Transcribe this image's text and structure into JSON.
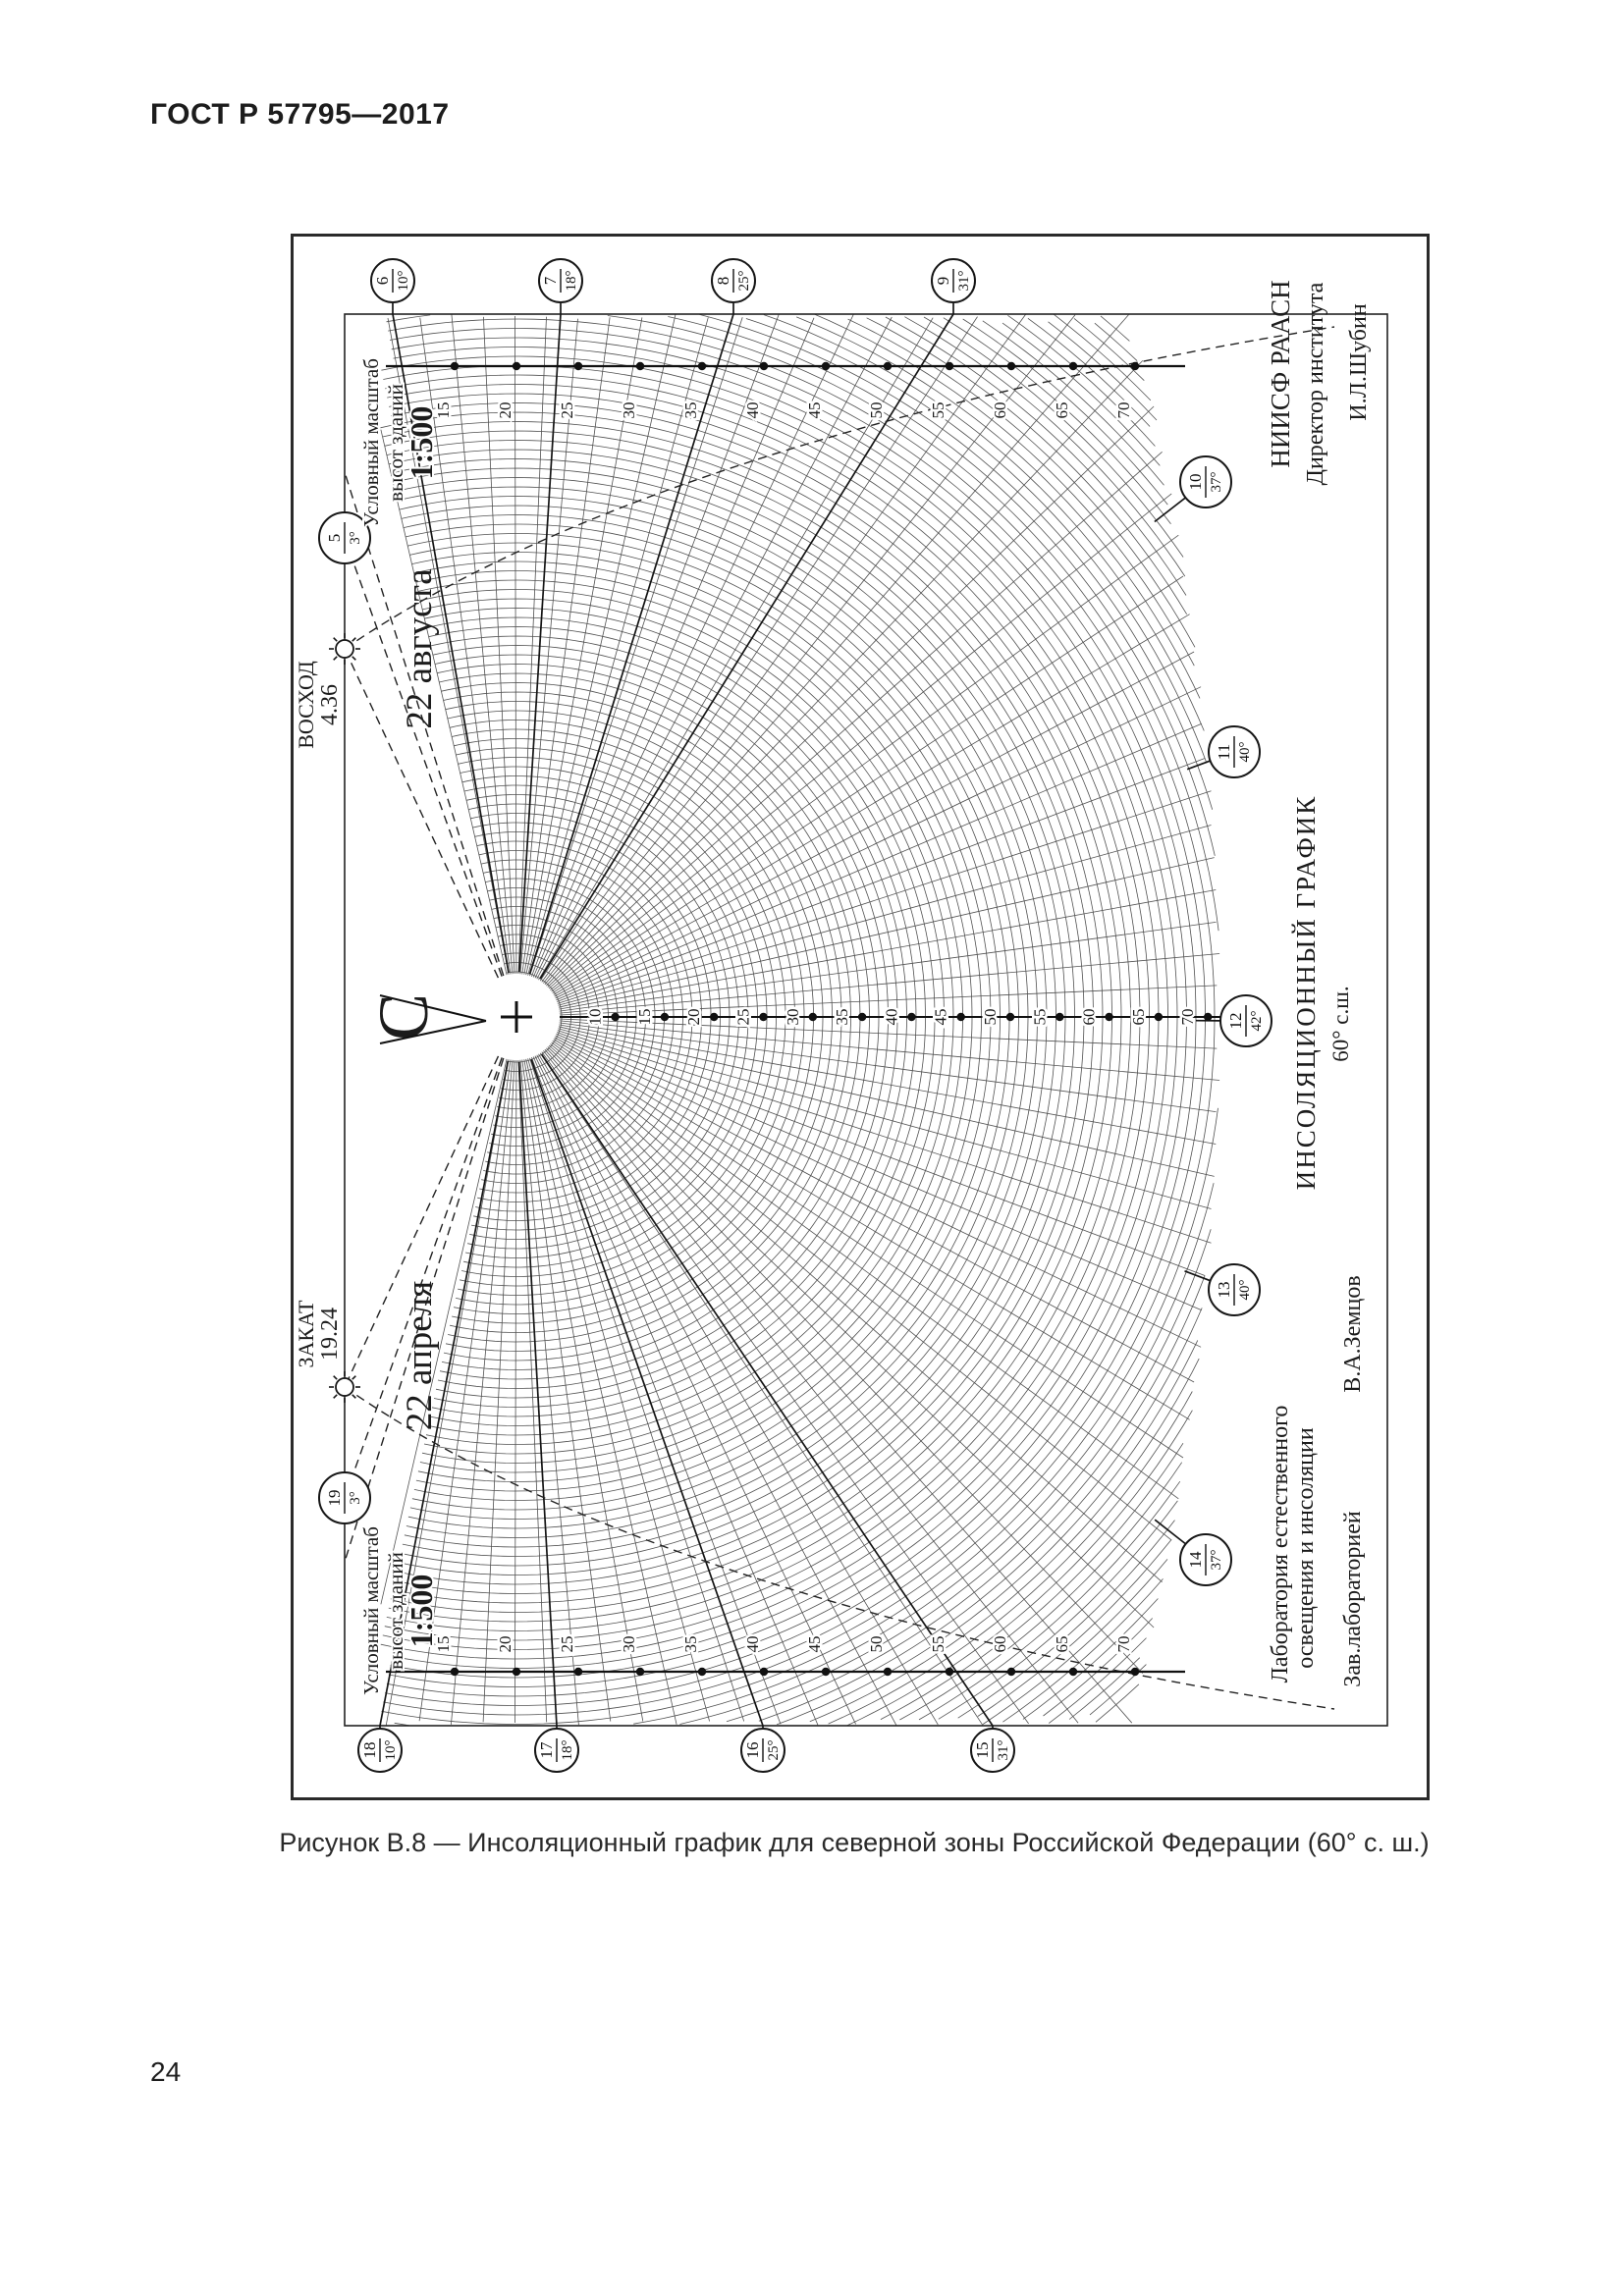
{
  "page": {
    "header": "ГОСТ Р 57795—2017",
    "page_number": "24",
    "figure_caption": "Рисунок В.8 — Инсоляционный график для северной зоны Российской Федерации (60° с. ш.)"
  },
  "chart": {
    "date_upper": "22  августа",
    "date_lower": "22  апреля",
    "sunrise": {
      "label": "ВОСХОД",
      "time": "4.36"
    },
    "sunset": {
      "label": "ЗАКАТ",
      "time": "19.24"
    },
    "scale_note": {
      "line1": "Условный масштаб",
      "line2": "высот зданий",
      "line3": "1:500"
    },
    "north_symbol": "С",
    "hour_markers": [
      {
        "hour": "5",
        "alt": "3°"
      },
      {
        "hour": "6",
        "alt": "10°"
      },
      {
        "hour": "7",
        "alt": "18°"
      },
      {
        "hour": "8",
        "alt": "25°"
      },
      {
        "hour": "9",
        "alt": "31°"
      },
      {
        "hour": "10",
        "alt": "37°"
      },
      {
        "hour": "11",
        "alt": "40°"
      },
      {
        "hour": "12",
        "alt": "42°"
      },
      {
        "hour": "13",
        "alt": "40°"
      },
      {
        "hour": "14",
        "alt": "37°"
      },
      {
        "hour": "15",
        "alt": "31°"
      },
      {
        "hour": "16",
        "alt": "25°"
      },
      {
        "hour": "17",
        "alt": "18°"
      },
      {
        "hour": "18",
        "alt": "10°"
      },
      {
        "hour": "19",
        "alt": "3°"
      }
    ],
    "ruler_values": [
      15,
      20,
      25,
      30,
      35,
      40,
      45,
      50,
      55,
      60,
      65,
      70
    ],
    "axis_values": [
      10,
      15,
      20,
      25,
      30,
      35,
      40,
      45,
      50,
      55,
      60,
      65,
      70
    ],
    "title_block": {
      "org_line1": "НИИСФ РААСН",
      "org_line2": "Директор института",
      "org_sign": "И.Л.Шубин",
      "chart_title": "ИНСОЛЯЦИОННЫЙ  ГРАФИК",
      "latitude": "60° с.ш.",
      "lab_line1": "Лаборатория естественного",
      "lab_line2": "освещения и инсоляции",
      "lab_head": "Зав.лабораторией",
      "lab_sign": "В.А.Земцов"
    }
  },
  "chart_data": {
    "type": "sun-path-insolation-diagram",
    "latitude_deg": 60,
    "hours": [
      5,
      6,
      7,
      8,
      9,
      10,
      11,
      12,
      13,
      14,
      15,
      16,
      17,
      18,
      19
    ],
    "solar_altitude_deg": [
      3,
      10,
      18,
      25,
      31,
      37,
      40,
      42,
      40,
      37,
      31,
      25,
      18,
      10,
      3
    ],
    "sunrise_time": "4.36",
    "sunset_time": "19.24",
    "dates": [
      "22 августа",
      "22 апреля"
    ],
    "height_scale": "1:500",
    "building_height_ruler_ticks": [
      15,
      20,
      25,
      30,
      35,
      40,
      45,
      50,
      55,
      60,
      65,
      70
    ],
    "central_axis_ticks": [
      10,
      15,
      20,
      25,
      30,
      35,
      40,
      45,
      50,
      55,
      60,
      65,
      70
    ]
  }
}
